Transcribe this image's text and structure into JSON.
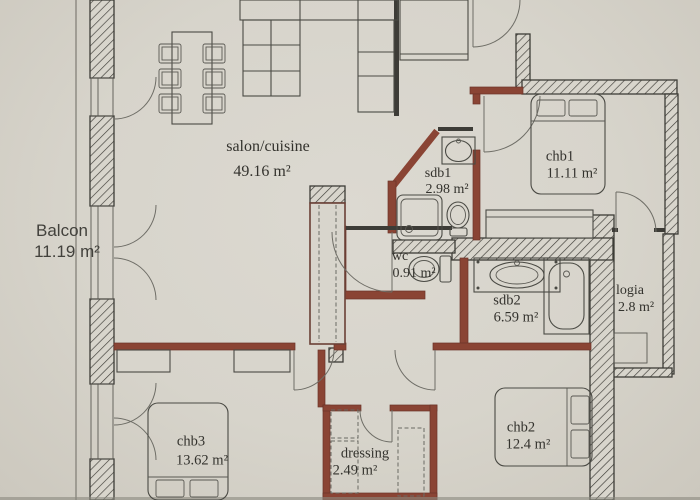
{
  "plan": {
    "type": "apartment-floor-plan",
    "units": "m²",
    "rooms": {
      "balcon": {
        "name": "Balcon",
        "area": "11.19 m²"
      },
      "salon": {
        "name": "salon/cuisine",
        "area": "49.16 m²"
      },
      "sdb1": {
        "name": "sdb1",
        "area": "2.98 m²"
      },
      "chb1": {
        "name": "chb1",
        "area": "11.11 m²"
      },
      "wc": {
        "name": "wc",
        "area": "0.91 m²"
      },
      "sdb2": {
        "name": "sdb2",
        "area": "6.59 m²"
      },
      "logia": {
        "name": "logia",
        "area": "2.8 m²"
      },
      "chb2": {
        "name": "chb2",
        "area": "12.4 m²"
      },
      "chb3": {
        "name": "chb3",
        "area": "13.62 m²"
      },
      "dressing": {
        "name": "dressing",
        "area": "2.49 m²"
      }
    },
    "colors": {
      "paper": "#d7d4cb",
      "partition_wall": "#8a4434",
      "exterior_wall_line": "#3d3c37",
      "drawing_line": "#4a4a44"
    }
  }
}
